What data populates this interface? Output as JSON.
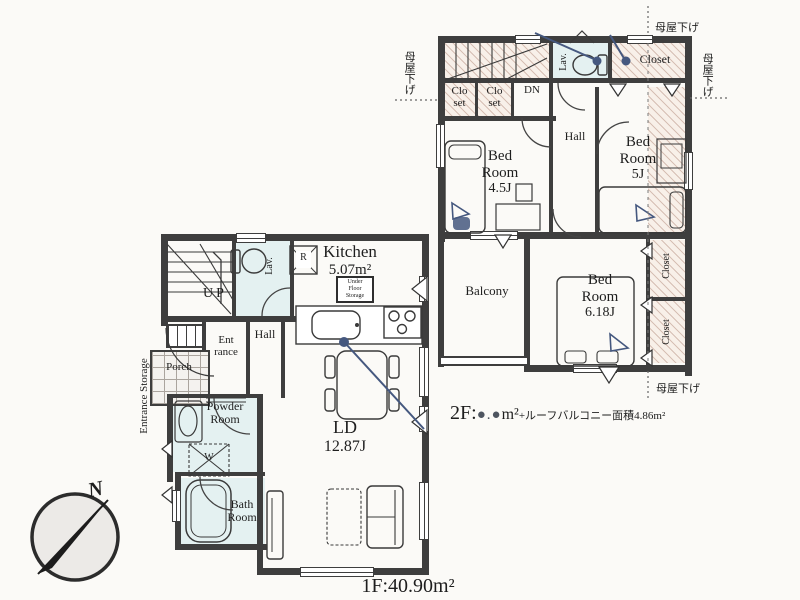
{
  "labels": {
    "floor1_area": "1F:40.90m²",
    "floor2_prefix": "2F:",
    "floor2_masked": "●.●",
    "floor2_unit": "m²",
    "floor2_suffix": "+ルーフバルコニー面積4.86m²",
    "moya_sage": "母屋下げ",
    "north": "N"
  },
  "floor1": {
    "kitchen_name": "Kitchen",
    "kitchen_area": "5.07m²",
    "ld_name": "LD",
    "ld_area": "12.87J",
    "bath_l1": "Bath",
    "bath_l2": "Room",
    "powder_l1": "Powder",
    "powder_l2": "Room",
    "hall": "Hall",
    "ent_l1": "Ent",
    "ent_l2": "rance",
    "porch": "Porch",
    "entrance_storage": "Entrance Storage",
    "lav": "Lav.",
    "up": "UP",
    "fridge": "R",
    "washer": "W",
    "ufs_l1": "Under",
    "ufs_l2": "Floor",
    "ufs_l3": "Storage"
  },
  "floor2": {
    "dn": "DN",
    "lav": "Lav.",
    "closet_top": "Closet",
    "closet_a_l1": "Clo",
    "closet_a_l2": "set",
    "closet_b_l1": "Clo",
    "closet_b_l2": "set",
    "bed45_l1": "Bed",
    "bed45_l2": "Room",
    "bed45_area": "4.5J",
    "bed5_l1": "Bed",
    "bed5_l2": "Room",
    "bed5_area": "5J",
    "bed618_l1": "Bed",
    "bed618_l2": "Room",
    "bed618_area": "6.18J",
    "hall": "Hall",
    "balcony": "Balcony",
    "closet_r1": "Closet",
    "closet_r2": "Closet"
  },
  "colors": {
    "wall": "#3e3e3e",
    "annotation_blue": "#45587f",
    "mask_dot": "#4e5560",
    "hatch_bg": "#f8f0e9",
    "wet_area": "#e4f1f1"
  }
}
